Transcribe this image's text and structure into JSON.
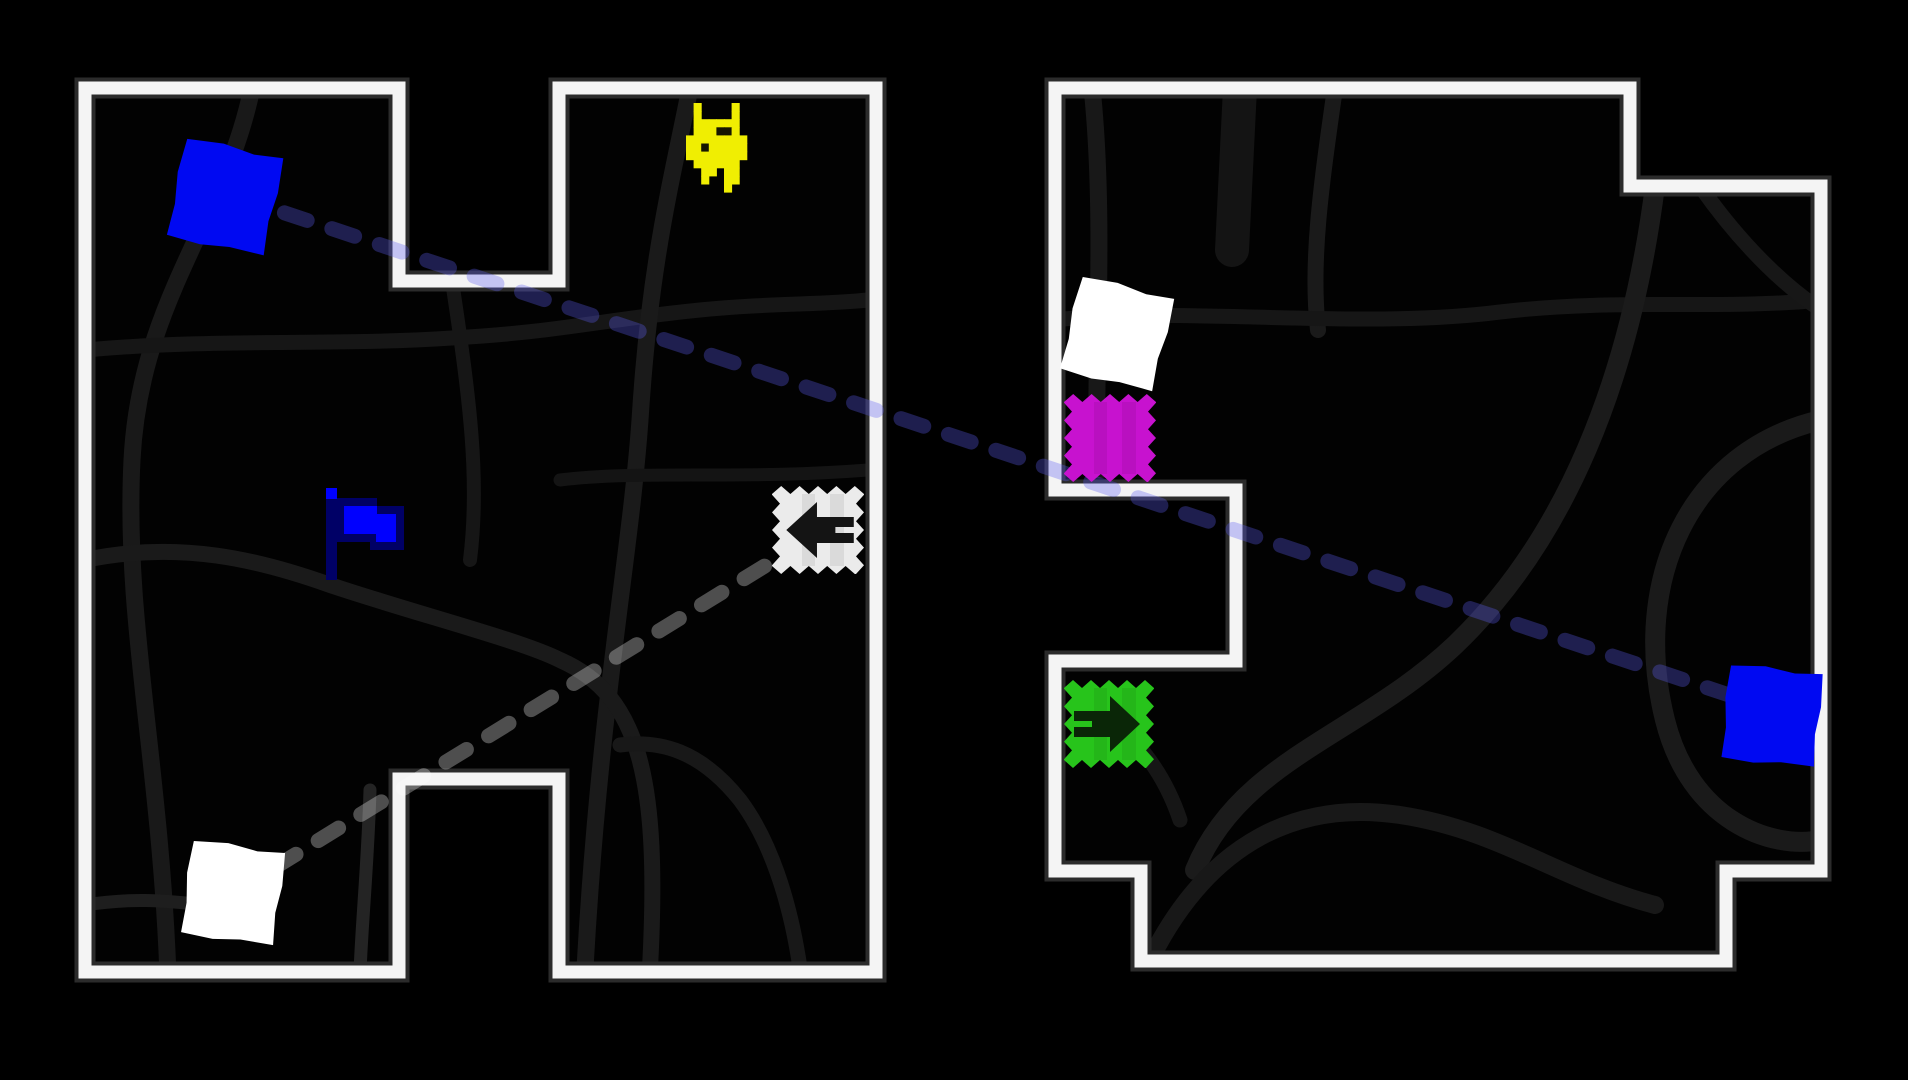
{
  "title": "2-13: TelePortals",
  "colors": {
    "background": "#000000",
    "wall_white": "#f4f4f4",
    "wall_fringe": "#2b2b2b",
    "maze_floor": "#020202",
    "link_blue": "rgba(92,92,242,0.32)",
    "link_gray": "rgba(255,255,255,0.30)"
  },
  "level": {
    "walls": [
      {
        "name": "left-room-wall",
        "points": "85,88 399,88 399,281 559,281 559,88 876,88 876,972 559,972 559,779 399,779 399,972 85,972"
      },
      {
        "name": "right-room-wall",
        "points": "1055,88 1630,88 1630,186 1821,186 1821,871 1726,871 1726,961 1141,961 1141,871 1055,871 1055,661 1236,661 1236,490 1055,490"
      }
    ],
    "roads": [
      {
        "room": 0,
        "d": "M 252,88 C 225,220 140,300 132,460 C 124,620 160,760 168,975",
        "w": 17,
        "c": "#191919"
      },
      {
        "room": 0,
        "d": "M 85,350 C 220,338 330,346 452,338 C 560,332 600,320 700,310 C 770,303 820,305 868,300",
        "w": 15,
        "c": "#161616"
      },
      {
        "room": 0,
        "d": "M 690,88 C 672,180 650,260 640,420 C 630,560 600,700 585,968",
        "w": 17,
        "c": "#1a1a1a"
      },
      {
        "room": 0,
        "d": "M 452,281 C 470,400 480,480 470,560",
        "w": 14,
        "c": "#161616"
      },
      {
        "room": 0,
        "d": "M 85,560 C 180,540 260,560 330,585 C 420,615 520,640 560,660 C 640,695 660,780 650,968",
        "w": 16,
        "c": "#1a1a1a"
      },
      {
        "room": 0,
        "d": "M 370,790 C 368,860 362,920 360,972",
        "w": 13,
        "c": "#242424"
      },
      {
        "room": 0,
        "d": "M 85,905 C 130,898 160,900 205,905",
        "w": 13,
        "c": "#1e1e1e"
      },
      {
        "room": 0,
        "d": "M 620,745 C 660,740 700,750 740,800 C 770,840 790,900 800,968",
        "w": 15,
        "c": "#181818"
      },
      {
        "room": 0,
        "d": "M 560,480 C 640,470 740,480 868,470",
        "w": 13,
        "c": "#141414"
      },
      {
        "room": 1,
        "d": "M 1092,88 C 1108,240 1090,420 1100,470",
        "w": 17,
        "c": "#181818"
      },
      {
        "room": 1,
        "d": "M 1335,88 C 1322,180 1310,260 1318,330",
        "w": 16,
        "c": "#1a1a1a"
      },
      {
        "room": 1,
        "d": "M 1055,320 C 1180,306 1360,330 1500,312 C 1620,298 1720,310 1822,300",
        "w": 15,
        "c": "#161616"
      },
      {
        "room": 1,
        "d": "M 1240,88 L 1232,250",
        "w": 34,
        "c": "#141414"
      },
      {
        "room": 1,
        "d": "M 1655,186 C 1630,380 1565,540 1455,645 C 1360,735 1240,760 1195,870",
        "w": 20,
        "c": "#1b1b1b"
      },
      {
        "room": 1,
        "d": "M 1821,420 C 1690,450 1630,580 1665,720 C 1690,820 1770,850 1821,840",
        "w": 20,
        "c": "#1a1a1a"
      },
      {
        "room": 1,
        "d": "M 1150,960 C 1210,840 1300,800 1400,815 C 1500,830 1560,880 1655,905",
        "w": 18,
        "c": "#181818"
      },
      {
        "room": 1,
        "d": "M 1700,186 C 1745,250 1790,290 1821,310",
        "w": 15,
        "c": "#171717"
      },
      {
        "room": 1,
        "d": "M 1080,700 C 1120,720 1160,760 1180,820",
        "w": 15,
        "c": "#161616"
      }
    ]
  },
  "links": [
    {
      "name": "teleport-link-blue",
      "color": "rgba(92,92,242,0.32)",
      "x1": 237,
      "y1": 197,
      "x2": 1792,
      "y2": 716
    },
    {
      "name": "teleport-link-gray",
      "color": "rgba(255,255,255,0.30)",
      "x1": 233,
      "y1": 893,
      "x2": 820,
      "y2": 532
    }
  ],
  "entities": [
    {
      "kind": "spinner",
      "name": "spinner-blue-left",
      "color": "#0009f2",
      "cx": 225,
      "cy": 197,
      "size": 98,
      "rot": 12
    },
    {
      "kind": "dog",
      "name": "player-dog",
      "color": "#f0ee02",
      "dark": "#151500",
      "x": 686,
      "y": 103
    },
    {
      "kind": "flag",
      "name": "goal-flag",
      "bright": "#0000ff",
      "dark": "#000066",
      "x": 326,
      "y": 486
    },
    {
      "kind": "stamp",
      "name": "teleportal-white",
      "color": "#ebebeb",
      "arrow": "left",
      "arrowColor": "#141414",
      "x": 772,
      "y": 486,
      "w": 92,
      "h": 88
    },
    {
      "kind": "spinner",
      "name": "spinner-white-left",
      "color": "#ffffff",
      "cx": 233,
      "cy": 893,
      "size": 92,
      "rot": 8
    },
    {
      "kind": "spinner",
      "name": "spinner-white-right",
      "color": "#ffffff",
      "cx": 1117,
      "cy": 334,
      "size": 94,
      "rot": 14
    },
    {
      "kind": "stamp",
      "name": "stamp-magenta",
      "color": "#c712cf",
      "arrow": "none",
      "arrowColor": "",
      "x": 1064,
      "y": 394,
      "w": 92,
      "h": 88
    },
    {
      "kind": "stamp",
      "name": "teleportal-green",
      "color": "#27c41b",
      "arrow": "right",
      "arrowColor": "#0a2607",
      "x": 1064,
      "y": 680,
      "w": 90,
      "h": 88
    },
    {
      "kind": "spinner",
      "name": "spinner-blue-right",
      "color": "#0009f2",
      "cx": 1772,
      "cy": 716,
      "size": 92,
      "rot": 6
    }
  ]
}
